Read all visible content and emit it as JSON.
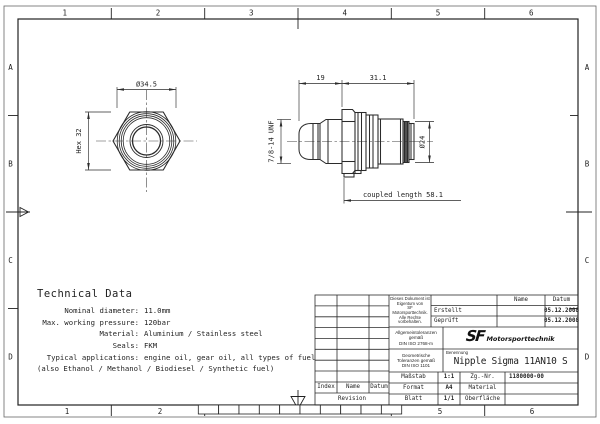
{
  "colors": {
    "ink": "#1f1f1f",
    "paper": "#ffffff"
  },
  "frame": {
    "top_numbers": [
      "1",
      "2",
      "3",
      "4",
      "5",
      "6"
    ],
    "bottom_numbers": [
      "1",
      "2",
      "5",
      "6"
    ],
    "side_letters": [
      "A",
      "B",
      "C",
      "D"
    ]
  },
  "drawing": {
    "front_view": {
      "diameter_dim": "Ø34.5",
      "hex_dim": "Hex 32"
    },
    "side_view": {
      "length_dim_1": "19",
      "length_dim_2": "31.1",
      "thread_callout": "7/8-14 UNF",
      "diameter_dim": "Ø24",
      "coupled_length_dim": "coupled length 58.1"
    }
  },
  "technical_data": {
    "title": "Technical Data",
    "rows": [
      {
        "label": "Nominal diameter:",
        "value": "11.0mm"
      },
      {
        "label": "Max. working pressure:",
        "value": "120bar"
      },
      {
        "label": "Material:",
        "value": "Aluminium / Stainless steel"
      },
      {
        "label": "Seals:",
        "value": "FKM"
      },
      {
        "label": "Typical applications:",
        "value": "engine oil, gear oil, all types of fuel"
      }
    ],
    "note": "(also Ethanol / Methanol / Biodiesel / Synthetic fuel)"
  },
  "title_block": {
    "ownership_note": "Dieses Dokument ist\nEigentum von\nSF Motorsporttechnik.\nAlle Rechte\nvorbehalten.",
    "general_tolerances": "Allgemeintoleranzen\ngemäß\nDIN ISO 2768-m",
    "geometric_tolerances": "Geometrische\nToleranzen gemäß\nDIN ISO 1101",
    "header_name": "Name",
    "header_datum": "Datum",
    "created_label": "Erstellt",
    "created_date": "05.12.2008",
    "checked_label": "Geprüft",
    "checked_date": "05.12.2008",
    "logo_sf": "SF",
    "logo_text": "Motorsporttechnik",
    "benennung_label": "Benennung",
    "part_name": "Nipple Sigma 11AN10 S",
    "massstab_label": "Maßstab",
    "massstab_value": "1:1",
    "zg_nr_label": "Zg.-Nr.",
    "zg_nr_value": "1180000-00",
    "format_label": "Format",
    "format_value": "A4",
    "material_label": "Material",
    "blatt_label": "Blatt",
    "blatt_value": "1/1",
    "oberflaeche_label": "Oberfläche",
    "index_label": "Index",
    "name_label": "Name",
    "datum_label": "Datum",
    "revision_label": "Revision"
  }
}
